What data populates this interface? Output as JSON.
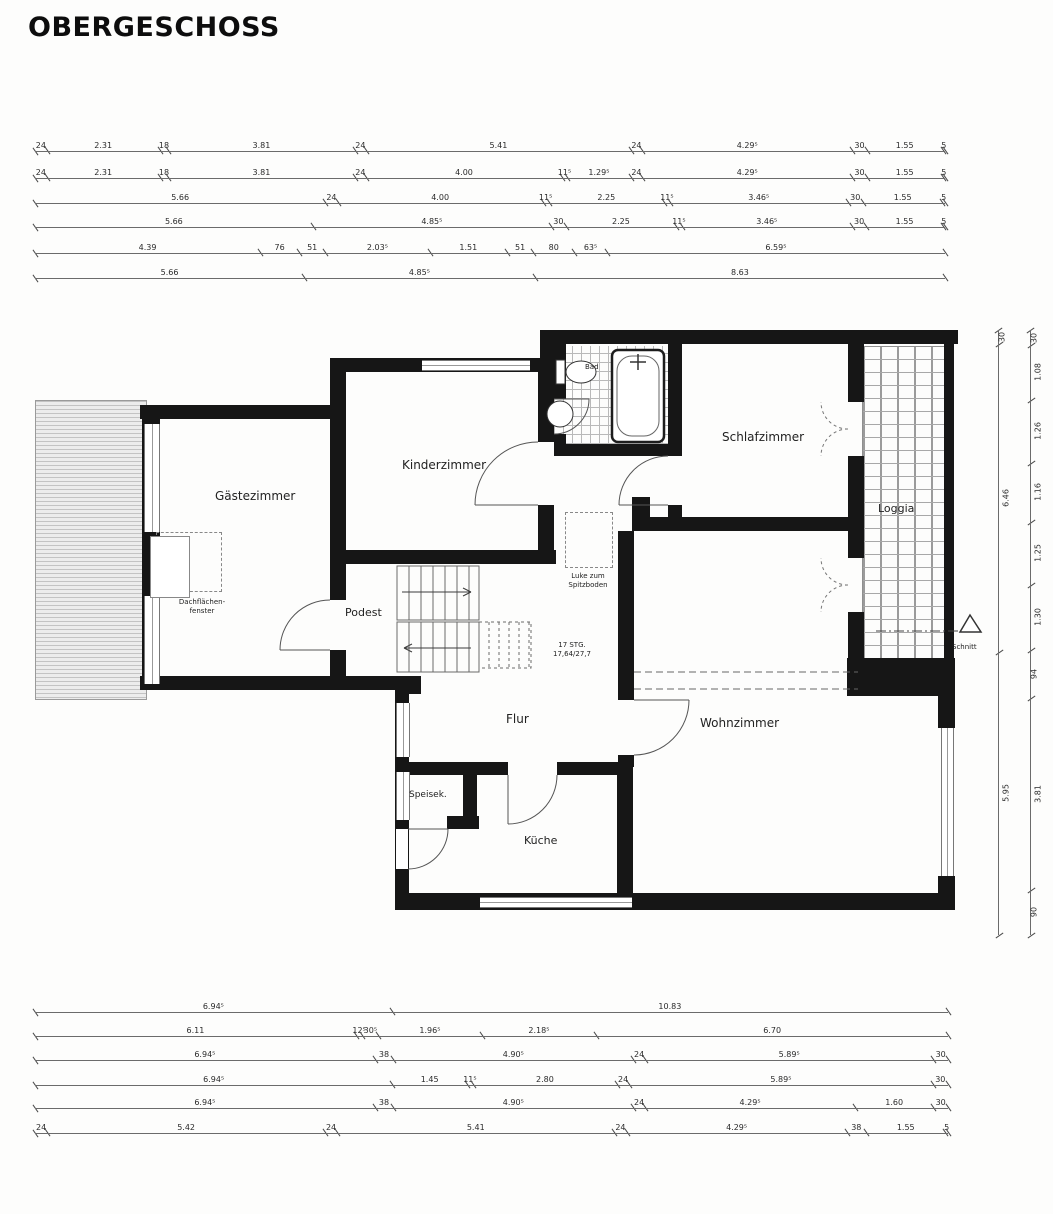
{
  "title": "OBERGESCHOSS",
  "rooms": {
    "gaestezimmer": "Gästezimmer",
    "kinderzimmer": "Kinderzimmer",
    "schlafzimmer": "Schlafzimmer",
    "loggia": "Loggia",
    "bad": "Bad",
    "podest": "Podest",
    "flur": "Flur",
    "wohnzimmer": "Wohnzimmer",
    "speisekammer": "Speisek.",
    "kueche": "Küche"
  },
  "annotations": {
    "dachfenster_line1": "Dachflächen-",
    "dachfenster_line2": "fenster",
    "luke_line1": "Luke zum",
    "luke_line2": "Spitzboden",
    "stairs_line1": "17 STG.",
    "stairs_line2": "17,64/27,7",
    "schnitt": "Schnitt"
  },
  "dimension_chains": {
    "top": [
      {
        "segments": [
          {
            "t": "24",
            "v": 0.24
          },
          {
            "t": "2.31",
            "v": 2.31
          },
          {
            "t": "18",
            "v": 0.18
          },
          {
            "t": "3.81",
            "v": 3.81
          },
          {
            "t": "24",
            "v": 0.24
          },
          {
            "t": "5.41",
            "v": 5.41
          },
          {
            "t": "24",
            "v": 0.24
          },
          {
            "t": "4.29⁵",
            "v": 4.295
          },
          {
            "t": "30",
            "v": 0.3
          },
          {
            "t": "1.55",
            "v": 1.55
          },
          {
            "t": "5",
            "v": 0.05
          }
        ]
      },
      {
        "segments": [
          {
            "t": "24",
            "v": 0.24
          },
          {
            "t": "2.31",
            "v": 2.31
          },
          {
            "t": "18",
            "v": 0.18
          },
          {
            "t": "3.81",
            "v": 3.81
          },
          {
            "t": "24",
            "v": 0.24
          },
          {
            "t": "4.00",
            "v": 4.0
          },
          {
            "t": "11⁵",
            "v": 0.115
          },
          {
            "t": "1.29⁵",
            "v": 1.295
          },
          {
            "t": "24",
            "v": 0.24
          },
          {
            "t": "4.29⁵",
            "v": 4.295
          },
          {
            "t": "30",
            "v": 0.3
          },
          {
            "t": "1.55",
            "v": 1.55
          },
          {
            "t": "5",
            "v": 0.05
          }
        ]
      },
      {
        "segments": [
          {
            "t": "5.66",
            "v": 5.66
          },
          {
            "t": "24",
            "v": 0.24
          },
          {
            "t": "4.00",
            "v": 4.0
          },
          {
            "t": "11⁵",
            "v": 0.115
          },
          {
            "t": "2.25",
            "v": 2.25
          },
          {
            "t": "11⁵",
            "v": 0.115
          },
          {
            "t": "3.46⁵",
            "v": 3.465
          },
          {
            "t": "30",
            "v": 0.3
          },
          {
            "t": "1.55",
            "v": 1.55
          },
          {
            "t": "5",
            "v": 0.05
          }
        ]
      },
      {
        "segments": [
          {
            "t": "5.66",
            "v": 5.66
          },
          {
            "t": "4.85⁵",
            "v": 4.855
          },
          {
            "t": "30",
            "v": 0.3
          },
          {
            "t": "2.25",
            "v": 2.25
          },
          {
            "t": "11⁵",
            "v": 0.115
          },
          {
            "t": "3.46⁵",
            "v": 3.465
          },
          {
            "t": "30",
            "v": 0.3
          },
          {
            "t": "1.55",
            "v": 1.55
          },
          {
            "t": "5",
            "v": 0.05
          }
        ]
      },
      {
        "segments": [
          {
            "t": "4.39",
            "v": 4.39
          },
          {
            "t": "76",
            "v": 0.76
          },
          {
            "t": "51",
            "v": 0.51
          },
          {
            "t": "2.03⁵",
            "v": 2.035
          },
          {
            "t": "1.51",
            "v": 1.51
          },
          {
            "t": "51",
            "v": 0.51
          },
          {
            "t": "80",
            "v": 0.8
          },
          {
            "t": "63⁵",
            "v": 0.635
          },
          {
            "t": "6.59⁵",
            "v": 6.595
          }
        ]
      },
      {
        "segments": [
          {
            "t": "5.66",
            "v": 5.66
          },
          {
            "t": "4.85⁵",
            "v": 4.855
          },
          {
            "t": "8.63",
            "v": 8.63
          }
        ]
      }
    ],
    "bottom": [
      {
        "segments": [
          {
            "t": "6.94⁵",
            "v": 6.945
          },
          {
            "t": "10.83",
            "v": 10.83
          }
        ]
      },
      {
        "segments": [
          {
            "t": "6.11",
            "v": 6.11
          },
          {
            "t": "12⁵",
            "v": 0.125
          },
          {
            "t": "30⁵",
            "v": 0.305
          },
          {
            "t": "1.96⁵",
            "v": 1.965
          },
          {
            "t": "2.18⁵",
            "v": 2.185
          },
          {
            "t": "6.70",
            "v": 6.7
          }
        ]
      },
      {
        "segments": [
          {
            "t": "6.94⁵",
            "v": 6.945
          },
          {
            "t": "38",
            "v": 0.38
          },
          {
            "t": "4.90⁵",
            "v": 4.905
          },
          {
            "t": "24",
            "v": 0.24
          },
          {
            "t": "5.89⁵",
            "v": 5.895
          },
          {
            "t": "30",
            "v": 0.3
          }
        ]
      },
      {
        "segments": [
          {
            "t": "6.94⁵",
            "v": 6.945
          },
          {
            "t": "1.45",
            "v": 1.45
          },
          {
            "t": "11⁵",
            "v": 0.115
          },
          {
            "t": "2.80",
            "v": 2.8
          },
          {
            "t": "24",
            "v": 0.24
          },
          {
            "t": "5.89⁵",
            "v": 5.895
          },
          {
            "t": "30",
            "v": 0.3
          }
        ]
      },
      {
        "segments": [
          {
            "t": "6.94⁵",
            "v": 6.945
          },
          {
            "t": "38",
            "v": 0.38
          },
          {
            "t": "4.90⁵",
            "v": 4.905
          },
          {
            "t": "24",
            "v": 0.24
          },
          {
            "t": "4.29⁵",
            "v": 4.295
          },
          {
            "t": "1.60",
            "v": 1.6
          },
          {
            "t": "30",
            "v": 0.3
          }
        ]
      },
      {
        "segments": [
          {
            "t": "24",
            "v": 0.24
          },
          {
            "t": "5.42",
            "v": 5.42
          },
          {
            "t": "24",
            "v": 0.24
          },
          {
            "t": "5.41",
            "v": 5.41
          },
          {
            "t": "24",
            "v": 0.24
          },
          {
            "t": "4.29⁵",
            "v": 4.295
          },
          {
            "t": "38",
            "v": 0.38
          },
          {
            "t": "1.55",
            "v": 1.55
          },
          {
            "t": "5",
            "v": 0.05
          }
        ]
      }
    ],
    "right_inner": {
      "segments": [
        {
          "t": "30",
          "v": 0.3
        },
        {
          "t": "6.46",
          "v": 6.46
        },
        {
          "t": "5.95",
          "v": 5.95
        }
      ]
    },
    "right_outer": {
      "segments": [
        {
          "t": "30",
          "v": 0.3
        },
        {
          "t": "1.08",
          "v": 1.08
        },
        {
          "t": "1.26",
          "v": 1.26
        },
        {
          "t": "1.16",
          "v": 1.16
        },
        {
          "t": "1.25",
          "v": 1.25
        },
        {
          "t": "1.30",
          "v": 1.3
        },
        {
          "t": "94",
          "v": 0.94
        },
        {
          "t": "3.81",
          "v": 3.81
        },
        {
          "t": "90",
          "v": 0.9
        }
      ]
    }
  }
}
